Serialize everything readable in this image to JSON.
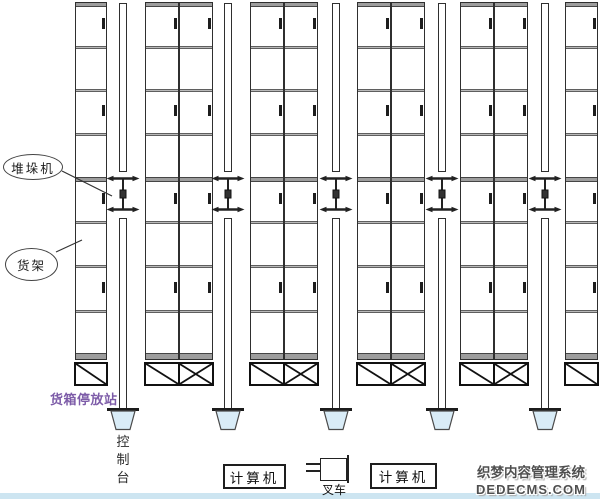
{
  "page": {
    "background": "#ffffff",
    "bottom_strip_color": "#cde5f1"
  },
  "labels": {
    "stacker_crane": "堆垛机",
    "rack": "货架",
    "container_station": "货箱停放站",
    "console": "控制台",
    "computer_left": "计算机",
    "computer_right": "计算机",
    "forklift": "叉车"
  },
  "watermark": {
    "line1": "织梦内容管理系统",
    "line2": "DEDECMS.COM"
  },
  "colors": {
    "line": "#2f2f2f",
    "shelf_line": "#b9b9b9",
    "shelf_edge": "#5f5f5f",
    "thick_bar": "#9d9d9d",
    "thick_bar_edge": "#454545",
    "tick": "#1d1d1d",
    "crane": "#222222",
    "trapezoid_fill": "#d9ecf7",
    "trapezoid_stroke": "#4a4a4a",
    "station_label": "#7d5ca8",
    "watermark_text": "#4f4f4f"
  },
  "diagram": {
    "rack_top": 2,
    "rack_bottom": 360,
    "shelf_lines": [
      47,
      90,
      134,
      222,
      266,
      311
    ],
    "thick_bar_y": 176,
    "tick_tops": [
      15,
      102,
      190,
      279
    ],
    "racks": [
      {
        "x": 75,
        "w": 32,
        "cols": 1
      },
      {
        "x": 145,
        "w": 68,
        "cols": 2
      },
      {
        "x": 250,
        "w": 68,
        "cols": 2
      },
      {
        "x": 357,
        "w": 68,
        "cols": 2
      },
      {
        "x": 460,
        "w": 68,
        "cols": 2
      },
      {
        "x": 565,
        "w": 33,
        "cols": 1
      }
    ],
    "rails": [
      {
        "cx": 123
      },
      {
        "cx": 228
      },
      {
        "cx": 336
      },
      {
        "cx": 442
      },
      {
        "cx": 545
      }
    ],
    "rail_w": 8,
    "upper_rail": {
      "top": 3,
      "bottom": 172
    },
    "crane_top": 175,
    "lower_rail": {
      "top": 218,
      "bottom": 409
    },
    "trapezoid_top": 408,
    "support_box": {
      "top": 362,
      "h": 24
    }
  }
}
